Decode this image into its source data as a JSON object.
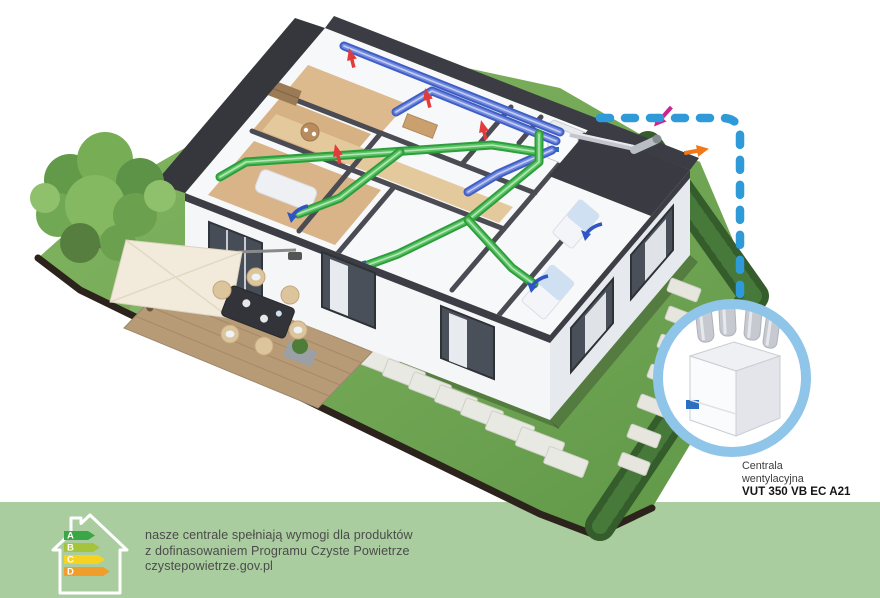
{
  "callout": {
    "label_line1": "Centrala",
    "label_line2": "wentylacyjna",
    "model": "VUT 350 VB EC A21"
  },
  "banner": {
    "background": "#aacd9f",
    "line1": "nasze centrale spełniają wymogi dla produktów",
    "line2": "z dofinasowaniem Programu Czyste Powietrze",
    "line3": "czystepowietrze.gov.pl",
    "energy_label": {
      "grades": [
        "A",
        "B",
        "C",
        "D"
      ],
      "grade_colors": [
        "#3aa646",
        "#a6c43b",
        "#f6d321",
        "#f09d2c"
      ]
    }
  },
  "colors": {
    "supply_duct_green": "#2e9e3c",
    "extract_duct_blue": "#3f5fc6",
    "connector_dashed_blue": "#2f9ad8",
    "callout_ring": "#8fc5e8",
    "intake_arrow_magenta": "#cf2390",
    "exhaust_arrow_orange": "#f07818",
    "extract_arrow_red": "#e23b3b",
    "supply_arrow_blue": "#2f55c4"
  }
}
